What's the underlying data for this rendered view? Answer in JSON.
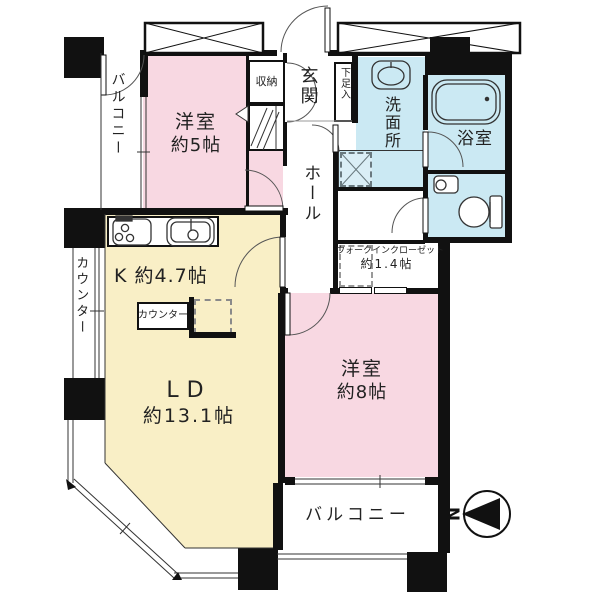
{
  "plan": {
    "colors": {
      "bedroom": "#f8d8e2",
      "living": "#f9efc6",
      "wet": "#cbe9f3",
      "pan": "#daeef6",
      "wall": "#111111"
    },
    "rooms": {
      "balcony_left": {
        "label": "バルコニー"
      },
      "bedroom5": {
        "name": "洋室",
        "size": "約5帖"
      },
      "storage": {
        "label": "収納"
      },
      "entrance": {
        "label": "玄関"
      },
      "shoe_box": {
        "label": "下足入"
      },
      "washroom": {
        "label": "洗面所"
      },
      "bathroom": {
        "label": "浴室"
      },
      "hall": {
        "label": "ホール"
      },
      "wic": {
        "name": "ウォークインクローゼット",
        "size": "約1.4帖"
      },
      "counter_bay": {
        "label": "カウンター"
      },
      "kitchen": {
        "label": "K 約4.7帖"
      },
      "counter_tag": {
        "label": "カウンター"
      },
      "living_dining": {
        "name": "LD",
        "size": "約13.1帖"
      },
      "bedroom8": {
        "name": "洋室",
        "size": "約8帖"
      },
      "balcony_bottom": {
        "label": "バルコニー"
      }
    },
    "compass": {
      "north_label": "N"
    }
  }
}
